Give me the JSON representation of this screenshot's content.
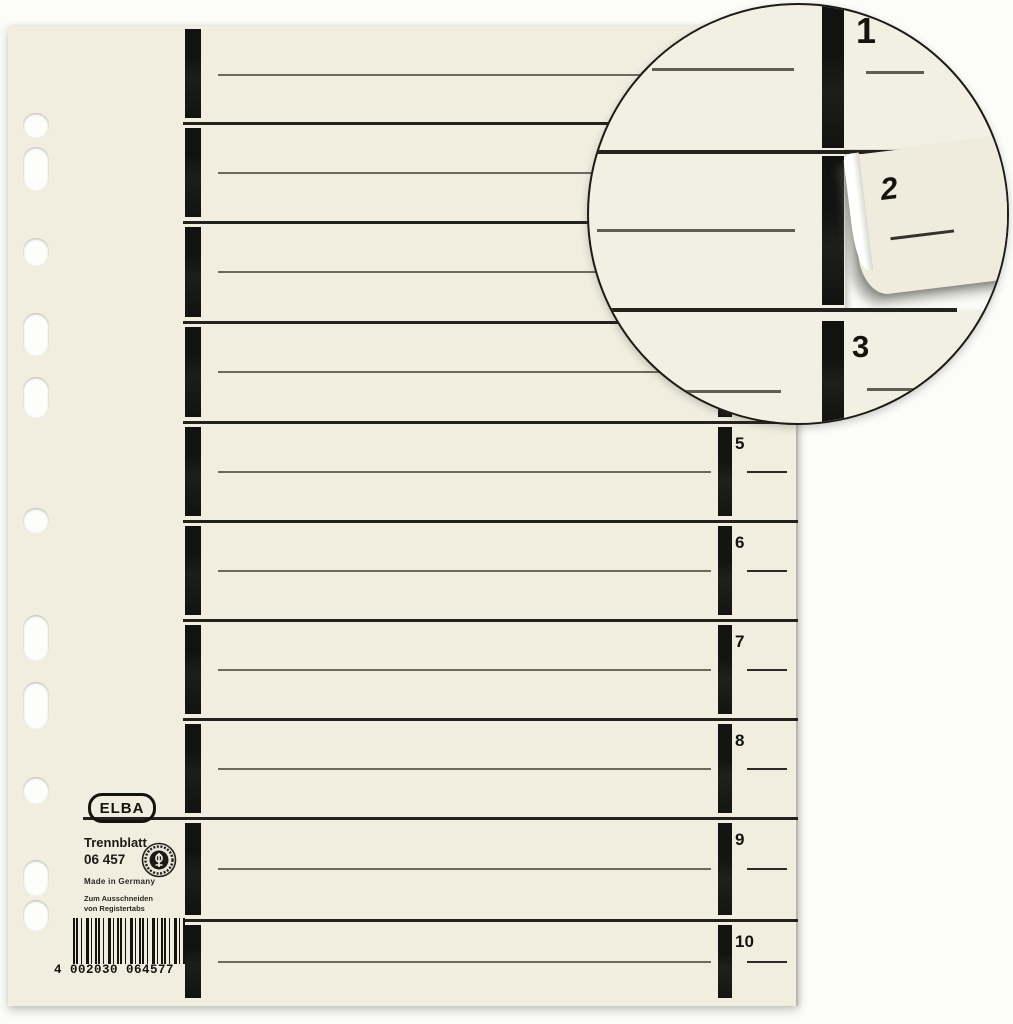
{
  "product": {
    "brand": "ELBA",
    "name": "Trennblatt",
    "article_number": "06 457",
    "origin": "Made in Germany",
    "note_lines": [
      "Zum Ausschneiden",
      "von Registertabs"
    ],
    "barcode": "4 002030 064577"
  },
  "sheet": {
    "hole_count": 11,
    "sections": [
      {
        "tab": "1",
        "occluded_by_inset": true
      },
      {
        "tab": "2",
        "occluded_by_inset": true
      },
      {
        "tab": "3",
        "occluded_by_inset": true
      },
      {
        "tab": "4",
        "occluded_by_inset": true
      },
      {
        "tab": "5"
      },
      {
        "tab": "6"
      },
      {
        "tab": "7"
      },
      {
        "tab": "8"
      },
      {
        "tab": "9"
      },
      {
        "tab": "10"
      }
    ]
  },
  "inset": {
    "tabs": [
      {
        "number": "1",
        "state": "intact"
      },
      {
        "number": "2",
        "state": "partially cut out"
      },
      {
        "number": "3",
        "state": "intact"
      }
    ]
  },
  "colors": {
    "paper": "#f1eee0",
    "ink": "#14140f",
    "rule_line": "#6b6a5c",
    "divider_line": "#23221e",
    "background": "#fcfcf9",
    "tab_backing": "#fbfbf7"
  }
}
